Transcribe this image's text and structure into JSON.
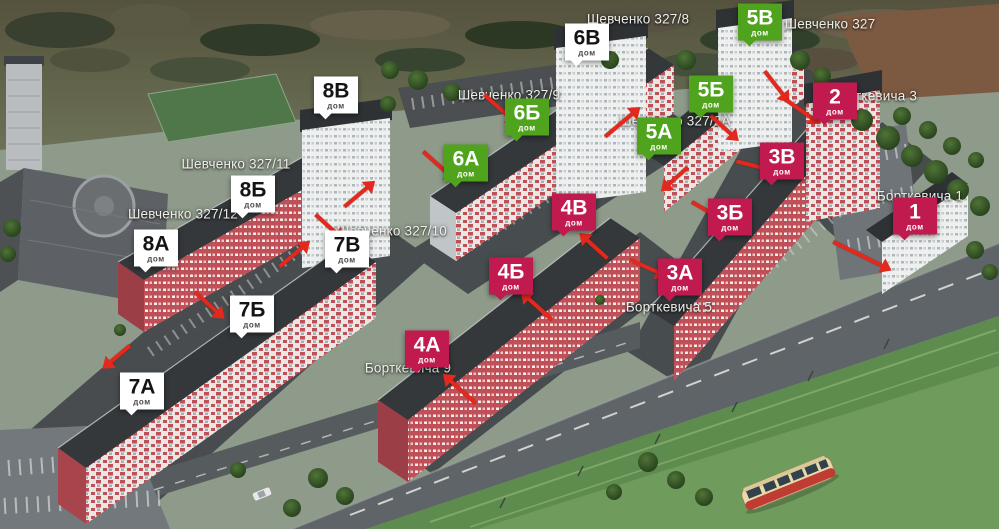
{
  "badges": [
    {
      "label": "7А",
      "sub": "дом",
      "variant": "white",
      "x": 142,
      "y": 391
    },
    {
      "label": "7Б",
      "sub": "дом",
      "variant": "white",
      "x": 252,
      "y": 314
    },
    {
      "label": "7В",
      "sub": "дом",
      "variant": "white",
      "x": 347,
      "y": 249
    },
    {
      "label": "8А",
      "sub": "дом",
      "variant": "white",
      "x": 156,
      "y": 248
    },
    {
      "label": "8Б",
      "sub": "дом",
      "variant": "white",
      "x": 253,
      "y": 194
    },
    {
      "label": "8В",
      "sub": "дом",
      "variant": "white",
      "x": 336,
      "y": 95
    },
    {
      "label": "6А",
      "sub": "дом",
      "variant": "green",
      "x": 466,
      "y": 163
    },
    {
      "label": "6Б",
      "sub": "дом",
      "variant": "green",
      "x": 527,
      "y": 117
    },
    {
      "label": "6В",
      "sub": "дом",
      "variant": "white",
      "x": 587,
      "y": 42
    },
    {
      "label": "5А",
      "sub": "дом",
      "variant": "green",
      "x": 659,
      "y": 136
    },
    {
      "label": "5Б",
      "sub": "дом",
      "variant": "green",
      "x": 711,
      "y": 94
    },
    {
      "label": "5В",
      "sub": "дом",
      "variant": "green",
      "x": 760,
      "y": 22
    },
    {
      "label": "4А",
      "sub": "дом",
      "variant": "crimson",
      "x": 427,
      "y": 349
    },
    {
      "label": "4Б",
      "sub": "дом",
      "variant": "crimson",
      "x": 511,
      "y": 276
    },
    {
      "label": "4В",
      "sub": "дом",
      "variant": "crimson",
      "x": 574,
      "y": 212
    },
    {
      "label": "3А",
      "sub": "дом",
      "variant": "crimson",
      "x": 680,
      "y": 277
    },
    {
      "label": "3Б",
      "sub": "дом",
      "variant": "crimson",
      "x": 730,
      "y": 217
    },
    {
      "label": "3В",
      "sub": "дом",
      "variant": "crimson",
      "x": 782,
      "y": 161
    },
    {
      "label": "2",
      "sub": "дом",
      "variant": "crimson",
      "x": 835,
      "y": 101
    },
    {
      "label": "1",
      "sub": "дом",
      "variant": "crimson",
      "x": 915,
      "y": 216
    }
  ],
  "streets": [
    {
      "text": "Шевченко 327/8",
      "x": 638,
      "y": 19
    },
    {
      "text": "Шевченко 327",
      "x": 830,
      "y": 24
    },
    {
      "text": "Шевченко 327/9",
      "x": 509,
      "y": 95
    },
    {
      "text": "Шевченко 327/2А",
      "x": 675,
      "y": 121
    },
    {
      "text": "Шевченко 327/11",
      "x": 236,
      "y": 164
    },
    {
      "text": "Шевченко 327/12",
      "x": 183,
      "y": 214
    },
    {
      "text": "Шевченко 327/10",
      "x": 392,
      "y": 231
    },
    {
      "text": "Борткевича 3",
      "x": 874,
      "y": 96
    },
    {
      "text": "Борткевича 1",
      "x": 920,
      "y": 196
    },
    {
      "text": "Борткевича 5",
      "x": 669,
      "y": 307
    },
    {
      "text": "Борткевича 9",
      "x": 408,
      "y": 368
    }
  ],
  "arrows": [
    {
      "x": 497,
      "y": 106,
      "deg": 42,
      "len": 34
    },
    {
      "x": 436,
      "y": 163,
      "deg": 42,
      "len": 34
    },
    {
      "x": 619,
      "y": 125,
      "deg": -40,
      "len": 36
    },
    {
      "x": 721,
      "y": 125,
      "deg": 42,
      "len": 28
    },
    {
      "x": 774,
      "y": 83,
      "deg": 52,
      "len": 30
    },
    {
      "x": 799,
      "y": 109,
      "deg": 35,
      "len": 32
    },
    {
      "x": 751,
      "y": 165,
      "deg": 14,
      "len": 30
    },
    {
      "x": 704,
      "y": 209,
      "deg": 30,
      "len": 28
    },
    {
      "x": 644,
      "y": 266,
      "deg": 24,
      "len": 30
    },
    {
      "x": 858,
      "y": 254,
      "deg": 26,
      "len": 55
    },
    {
      "x": 326,
      "y": 224,
      "deg": 42,
      "len": 28
    },
    {
      "x": 356,
      "y": 197,
      "deg": -40,
      "len": 30
    },
    {
      "x": 291,
      "y": 257,
      "deg": -40,
      "len": 30
    },
    {
      "x": 206,
      "y": 302,
      "deg": 42,
      "len": 30
    },
    {
      "x": 120,
      "y": 354,
      "deg": 140,
      "len": 26
    },
    {
      "x": 463,
      "y": 392,
      "deg": -138,
      "len": 34
    },
    {
      "x": 540,
      "y": 309,
      "deg": -138,
      "len": 32
    },
    {
      "x": 597,
      "y": 249,
      "deg": -138,
      "len": 28
    },
    {
      "x": 678,
      "y": 176,
      "deg": 138,
      "len": 26
    }
  ],
  "colors": {
    "badge_green": "#50a31c",
    "badge_crimson": "#c01a4e",
    "badge_white": "#ffffff",
    "badge_text_dark": "#141414",
    "arrow_red": "#e3291d",
    "street_text": "#efefe9"
  }
}
